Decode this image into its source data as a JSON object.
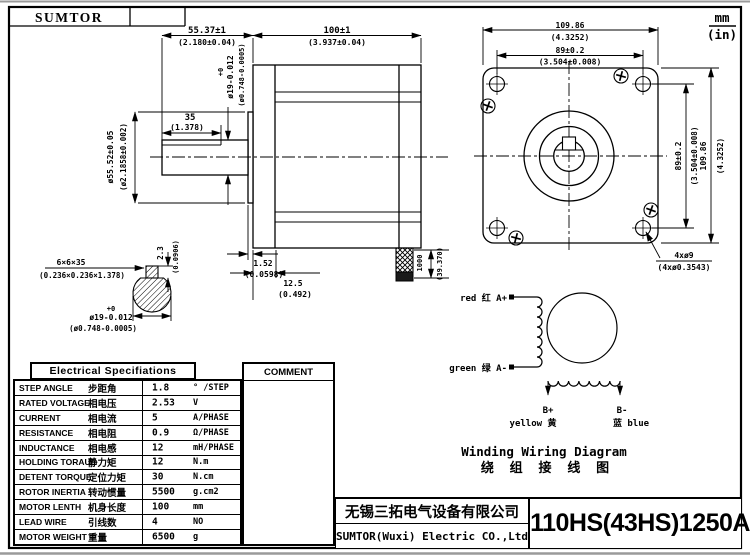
{
  "frame": {
    "logo": "SUMTOR",
    "unit_mm": "mm",
    "unit_in": "(in)"
  },
  "side_view": {
    "dim_shaft_to_face_mm": "55.37±1",
    "dim_shaft_to_face_in": "(2.180±0.04)",
    "dim_body_mm": "100±1",
    "dim_body_in": "(3.937±0.04)",
    "shaft_tol_plus": "+0",
    "shaft_dia_mm": "ø19-0.012",
    "shaft_dia_in": "(ø0.748-0.0005)",
    "dim_flat_mm": "35",
    "dim_flat_in": "(1.378)",
    "boss_dia_mm": "ø55.52±0.05",
    "boss_dia_in": "(ø2.1858±0.002)",
    "boss_h_mm": "1.52",
    "boss_h_in": "(0.0598)",
    "front_step_mm": "12.5",
    "front_step_in": "(0.492)",
    "cable_mm": "1000",
    "cable_in": "(39.370)"
  },
  "key_detail": {
    "key_mm": "6×6×35",
    "key_in": "(0.236×0.236×1.378)",
    "flat_mm": "2.3",
    "flat_in": "(0.0906)",
    "tol_plus": "+0",
    "dia_mm": "ø19-0.012",
    "dia_in": "(ø0.748-0.0005)"
  },
  "front_view": {
    "width_mm": "109.86",
    "width_in": "(4.3252)",
    "holes_h_mm": "89±0.2",
    "holes_h_in": "(3.504±0.008)",
    "holes_v_mm": "89±0.2",
    "holes_v_in": "(3.504±0.008)",
    "height_mm": "109.86",
    "height_in": "(4.3252)",
    "holes_mm": "4xø9",
    "holes_in": "(4xø0.3543)"
  },
  "wiring": {
    "a_plus": "red 红 A+",
    "a_minus": "green 绿 A-",
    "b_plus": "B+",
    "b_plus_color": "yellow 黄",
    "b_minus": "B-",
    "b_minus_color": "蓝 blue",
    "title_en": "Winding Wiring Diagram",
    "title_cn": "绕 组 接 线 图"
  },
  "spec_table": {
    "title": "Electrical Specifiations",
    "comment_header": "COMMENT",
    "rows": [
      {
        "en": "STEP ANGLE",
        "cn": "步距角",
        "val": "1.8",
        "unit": "° /STEP"
      },
      {
        "en": "RATED VOLTAGE",
        "cn": "相电压",
        "val": "2.53",
        "unit": "V"
      },
      {
        "en": "CURRENT",
        "cn": "相电流",
        "val": "5",
        "unit": "A/PHASE"
      },
      {
        "en": "RESISTANCE",
        "cn": "相电阻",
        "val": "0.9",
        "unit": "Ω/PHASE"
      },
      {
        "en": "INDUCTANCE",
        "cn": "相电感",
        "val": "12",
        "unit": "mH/PHASE"
      },
      {
        "en": "HOLDING TORAUE",
        "cn": "静力矩",
        "val": "12",
        "unit": "N.m"
      },
      {
        "en": "DETENT TORQUE",
        "cn": "定位力矩",
        "val": "30",
        "unit": "N.cm"
      },
      {
        "en": "ROTOR INERTIA",
        "cn": "转动惯量",
        "val": "5500",
        "unit": "g.cm2"
      },
      {
        "en": "MOTOR LENTH",
        "cn": "机身长度",
        "val": "100",
        "unit": "mm"
      },
      {
        "en": "LEAD WIRE",
        "cn": "引线数",
        "val": "4",
        "unit": "NO"
      },
      {
        "en": "MOTOR WEIGHT",
        "cn": "重量",
        "val": "6500",
        "unit": "g"
      }
    ]
  },
  "title_block": {
    "company_cn": "无锡三拓电气设备有限公司",
    "company_en": "SUMTOR(Wuxi) Electric CO.,Ltd",
    "model": "110HS(43HS)1250A4"
  }
}
